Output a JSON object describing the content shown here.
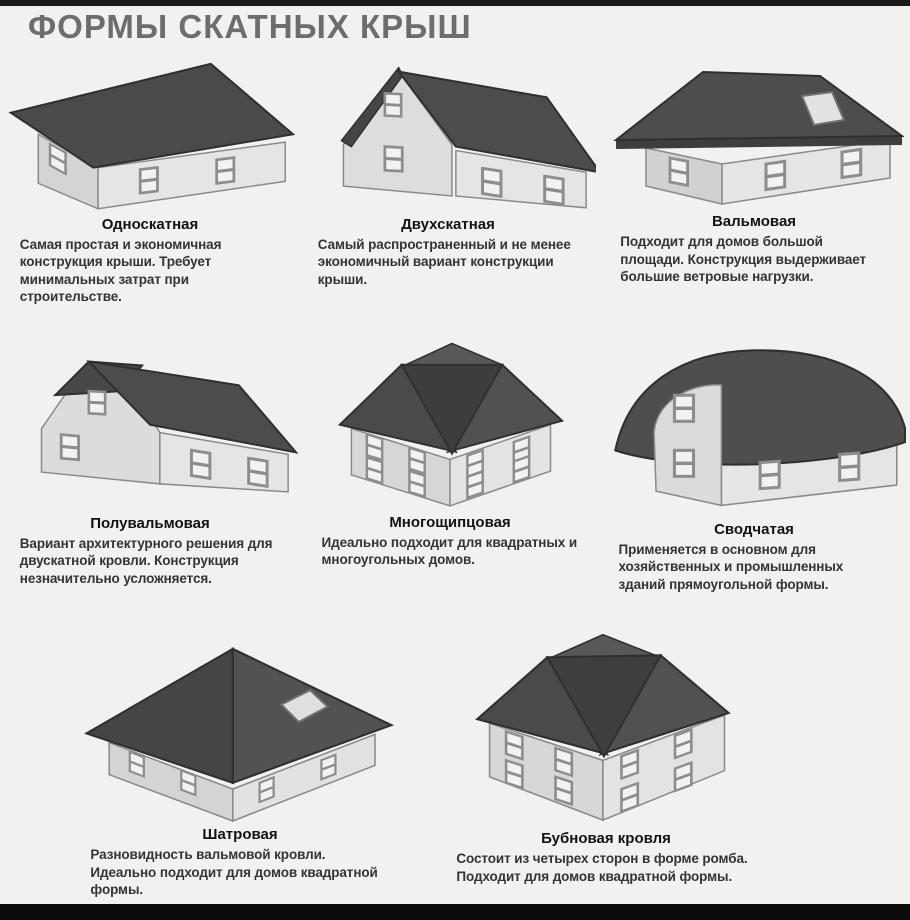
{
  "page": {
    "title": "ФОРМЫ СКАТНЫХ КРЫШ"
  },
  "colors": {
    "background": "#f2f1ef",
    "roof_dark": "#4a4a4a",
    "roof_valley": "#3d3d3d",
    "wall_light": "#e4e3e1",
    "wall_shaded": "#d6d5d3",
    "title_gray": "#6d6d6b"
  },
  "roof_types": [
    {
      "name": "Односкатная",
      "description": "Самая простая и экономичная конструкция крыши. Требует минимальных затрат при строительстве."
    },
    {
      "name": "Двухскатная",
      "description": "Самый распространенный и не менее экономичный вариант конструкции крыши."
    },
    {
      "name": "Вальмовая",
      "description": "Подходит для домов большой площади. Конструкция выдерживает большие ветровые нагрузки."
    },
    {
      "name": "Полувальмовая",
      "description": "Вариант архитектурного решения для двускатной кровли. Конструкция незначительно усложняется."
    },
    {
      "name": "Многощипцовая",
      "description": "Идеально подходит для квадратных и многоугольных домов."
    },
    {
      "name": "Сводчатая",
      "description": "Применяется в основном для хозяйственных и промышленных зданий прямоугольной формы."
    },
    {
      "name": "Шатровая",
      "description": "Разновидность вальмовой кровли. Идеально подходит для домов квадратной формы."
    },
    {
      "name": "Бубновая кровля",
      "description": "Состоит из четырех сторон в форме ромба. Подходит для домов квадратной формы."
    }
  ]
}
